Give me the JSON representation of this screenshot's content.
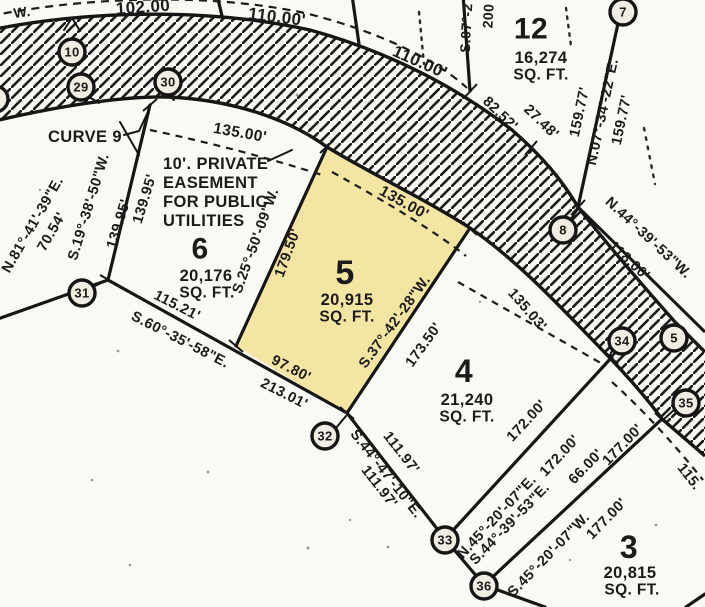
{
  "map": {
    "type": "plat-survey-map",
    "colors": {
      "paper": "#fbf9f3",
      "ink": "#1b1b1b",
      "lot5_highlight": "#f4e5a3"
    },
    "lots": [
      {
        "number": "12",
        "area": "16,274 SQ. FT."
      },
      {
        "number": "6",
        "area": "20,176 SQ. FT."
      },
      {
        "number": "5",
        "area": "20,915 SQ. FT.",
        "highlighted": true
      },
      {
        "number": "4",
        "area": "21,240 SQ. FT."
      },
      {
        "number": "3",
        "area": "20,815 SQ. FT."
      }
    ],
    "labels": [
      {
        "id": "fragment-w",
        "t": "W.",
        "x": 22,
        "y": 12,
        "r": -8,
        "s": 14
      },
      {
        "id": "dim-102-00",
        "t": "102.00",
        "x": 143,
        "y": 7,
        "r": -4,
        "s": 17
      },
      {
        "id": "dim-110-00-a",
        "t": "110.00'",
        "x": 277,
        "y": 17,
        "r": 7,
        "s": 17
      },
      {
        "id": "dim-110-00-b",
        "t": "110.00'",
        "x": 420,
        "y": 62,
        "r": 24,
        "s": 17
      },
      {
        "id": "bearing-s07-partial",
        "t": "S.07°-2",
        "x": 466,
        "y": 28,
        "r": -87,
        "s": 14
      },
      {
        "id": "dim-200-partial",
        "t": "200",
        "x": 488,
        "y": 16,
        "r": -87,
        "s": 14
      },
      {
        "id": "lot12-number",
        "t": "12",
        "x": 531,
        "y": 29,
        "r": 0,
        "s": 30
      },
      {
        "id": "lot12-area",
        "t": "16,274",
        "x": 541,
        "y": 58,
        "r": 0,
        "s": 16.5
      },
      {
        "id": "lot12-sqft",
        "t": "SQ. FT.",
        "x": 541,
        "y": 75,
        "r": 0,
        "s": 15.5
      },
      {
        "id": "dim-82-52",
        "t": "82.52'",
        "x": 500,
        "y": 114,
        "r": 44,
        "s": 14.5
      },
      {
        "id": "dim-27-48",
        "t": "27.48'",
        "x": 541,
        "y": 122,
        "r": 44,
        "s": 14.5
      },
      {
        "id": "dim-159-77-a",
        "t": "159.77'",
        "x": 580,
        "y": 112,
        "r": -78,
        "s": 14.5
      },
      {
        "id": "bearing-n07-34-22e",
        "t": "N.07°-34'-22\"E.",
        "x": 603,
        "y": 112,
        "r": -78,
        "s": 14.5
      },
      {
        "id": "dim-159-77-b",
        "t": "159.77'",
        "x": 622,
        "y": 120,
        "r": -78,
        "s": 14.5
      },
      {
        "id": "bearing-n44-39-53w",
        "t": "N.44°-39'-53\"W.",
        "x": 648,
        "y": 238,
        "r": 43,
        "s": 14.5
      },
      {
        "id": "dim-118-00",
        "t": "118.00'",
        "x": 629,
        "y": 261,
        "r": 43,
        "s": 14.5
      },
      {
        "id": "curve-9",
        "t": "CURVE 9",
        "x": 85,
        "y": 137,
        "r": 0,
        "s": 16.5
      },
      {
        "id": "dim-135-00-lot6",
        "t": "135.00'",
        "x": 240,
        "y": 133,
        "r": 10,
        "s": 15.5
      },
      {
        "id": "easement-line-1",
        "t": "10'. PRIVATE",
        "x": 163,
        "y": 164,
        "r": 0,
        "s": 16.5,
        "a": "s"
      },
      {
        "id": "easement-line-2",
        "t": "EASEMENT",
        "x": 163,
        "y": 183,
        "r": 0,
        "s": 16.5,
        "a": "s"
      },
      {
        "id": "easement-line-3",
        "t": "FOR PUBLIC",
        "x": 163,
        "y": 202,
        "r": 0,
        "s": 16.5,
        "a": "s"
      },
      {
        "id": "easement-line-4",
        "t": "UTILITIES",
        "x": 163,
        "y": 221,
        "r": 0,
        "s": 16.5,
        "a": "s"
      },
      {
        "id": "lot6-number",
        "t": "6",
        "x": 200,
        "y": 249,
        "r": 0,
        "s": 30
      },
      {
        "id": "lot6-area",
        "t": "20,176",
        "x": 206,
        "y": 276,
        "r": 0,
        "s": 16.5
      },
      {
        "id": "lot6-sqft",
        "t": "SQ. FT.",
        "x": 207,
        "y": 293,
        "r": 0,
        "s": 15.5
      },
      {
        "id": "bearing-s19-38-50w",
        "t": "S.19°-38'-50\"W.",
        "x": 89,
        "y": 207,
        "r": -73,
        "s": 14.5
      },
      {
        "id": "dim-139-95-a",
        "t": "139.95'",
        "x": 119,
        "y": 224,
        "r": -73,
        "s": 14.5
      },
      {
        "id": "dim-139-95-b",
        "t": "139.95'",
        "x": 145,
        "y": 199,
        "r": -73,
        "s": 14.5
      },
      {
        "id": "bearing-n81-41-39e",
        "t": "N.81°-41'-39\"E.",
        "x": 33,
        "y": 225,
        "r": -60,
        "s": 14.5
      },
      {
        "id": "dim-70-54",
        "t": "70.54'",
        "x": 52,
        "y": 232,
        "r": -60,
        "s": 14.5
      },
      {
        "id": "dim-115-21",
        "t": "115.21'",
        "x": 177,
        "y": 306,
        "r": 27,
        "s": 14.5
      },
      {
        "id": "bearing-s60-35-58e",
        "t": "S.60°-35'-58\"E.",
        "x": 180,
        "y": 340,
        "r": 27,
        "s": 14.5
      },
      {
        "id": "dim-213-01",
        "t": "213.01'",
        "x": 284,
        "y": 394,
        "r": 27,
        "s": 14.5
      },
      {
        "id": "lot5-number",
        "t": "5",
        "x": 345,
        "y": 273,
        "r": 0,
        "s": 34
      },
      {
        "id": "lot5-area",
        "t": "20,915",
        "x": 347,
        "y": 300,
        "r": 0,
        "s": 16.5
      },
      {
        "id": "lot5-sqft",
        "t": "SQ. FT.",
        "x": 347,
        "y": 317,
        "r": 0,
        "s": 15.5
      },
      {
        "id": "bearing-s25-50-09w",
        "t": "S.25°-50'-09\"W.",
        "x": 256,
        "y": 241,
        "r": -70,
        "s": 14.5
      },
      {
        "id": "dim-179-50",
        "t": "179.50'",
        "x": 288,
        "y": 253,
        "r": -70,
        "s": 14.5
      },
      {
        "id": "dim-135-00-lot5",
        "t": "135.00'",
        "x": 404,
        "y": 203,
        "r": 29,
        "s": 15.5
      },
      {
        "id": "dim-97-80",
        "t": "97.80'",
        "x": 291,
        "y": 369,
        "r": 27,
        "s": 14.5
      },
      {
        "id": "bearing-s37-42-28w",
        "t": "S.37°-42'-28\"W.",
        "x": 395,
        "y": 322,
        "r": -54,
        "s": 14.5
      },
      {
        "id": "dim-173-50",
        "t": "173.50'",
        "x": 424,
        "y": 345,
        "r": -54,
        "s": 14.5
      },
      {
        "id": "lot4-number",
        "t": "4",
        "x": 464,
        "y": 371,
        "r": 0,
        "s": 32
      },
      {
        "id": "lot4-area",
        "t": "21,240",
        "x": 467,
        "y": 400,
        "r": 0,
        "s": 16.5
      },
      {
        "id": "lot4-sqft",
        "t": "SQ. FT.",
        "x": 467,
        "y": 417,
        "r": 0,
        "s": 15.5
      },
      {
        "id": "dim-135-03",
        "t": "135.03'",
        "x": 527,
        "y": 310,
        "r": 49,
        "s": 14.5
      },
      {
        "id": "dim-111-97-a",
        "t": "111.97'",
        "x": 401,
        "y": 453,
        "r": 52,
        "s": 14.5
      },
      {
        "id": "bearing-s44-47-10e",
        "t": "S.44°-47'-10\"E.",
        "x": 386,
        "y": 474,
        "r": 52,
        "s": 14.5
      },
      {
        "id": "dim-111-97-b",
        "t": "111.97'",
        "x": 379,
        "y": 487,
        "r": 52,
        "s": 14.5
      },
      {
        "id": "dim-172-00-a",
        "t": "172.00'",
        "x": 527,
        "y": 421,
        "r": -47,
        "s": 14.5
      },
      {
        "id": "bearing-n45-20-07e",
        "t": "N.45°-20'-07\"E.",
        "x": 497,
        "y": 517,
        "r": -47,
        "s": 14.5
      },
      {
        "id": "dim-172-00-b",
        "t": "172.00'",
        "x": 560,
        "y": 456,
        "r": -47,
        "s": 14.5
      },
      {
        "id": "bearing-s44-39-53e",
        "t": "S.44°-39'-53\"E.",
        "x": 510,
        "y": 524,
        "r": -46,
        "s": 14.5
      },
      {
        "id": "dim-66-00",
        "t": "66.00'",
        "x": 586,
        "y": 467,
        "r": -46,
        "s": 14.5
      },
      {
        "id": "bearing-s45-20-07w",
        "t": "S.45°-20'-07\"W.",
        "x": 549,
        "y": 555,
        "r": -46,
        "s": 14.5
      },
      {
        "id": "dim-177-00-a",
        "t": "177.00'",
        "x": 623,
        "y": 445,
        "r": -46,
        "s": 14.5
      },
      {
        "id": "dim-177-00-b",
        "t": "177.00'",
        "x": 607,
        "y": 519,
        "r": -46,
        "s": 14.5
      },
      {
        "id": "lot3-number",
        "t": "3",
        "x": 629,
        "y": 547,
        "r": 0,
        "s": 32
      },
      {
        "id": "lot3-area",
        "t": "20,815",
        "x": 630,
        "y": 573,
        "r": 0,
        "s": 16.5
      },
      {
        "id": "lot3-sqft",
        "t": "SQ. FT.",
        "x": 632,
        "y": 590,
        "r": 0,
        "s": 15.5
      },
      {
        "id": "dim-115-partial",
        "t": "115.",
        "x": 689,
        "y": 477,
        "r": 52,
        "s": 14.5
      }
    ],
    "markers": [
      {
        "id": "marker-edge-partial",
        "n": "",
        "x": -5,
        "y": 99
      },
      {
        "id": "marker-10",
        "n": "10",
        "x": 72,
        "y": 52
      },
      {
        "id": "marker-29",
        "n": "29",
        "x": 81,
        "y": 87
      },
      {
        "id": "marker-30",
        "n": "30",
        "x": 168,
        "y": 82
      },
      {
        "id": "marker-31",
        "n": "31",
        "x": 82,
        "y": 293
      },
      {
        "id": "marker-32",
        "n": "32",
        "x": 325,
        "y": 436
      },
      {
        "id": "marker-33",
        "n": "33",
        "x": 445,
        "y": 540
      },
      {
        "id": "marker-36",
        "n": "36",
        "x": 484,
        "y": 586
      },
      {
        "id": "marker-8",
        "n": "8",
        "x": 563,
        "y": 230
      },
      {
        "id": "marker-34",
        "n": "34",
        "x": 622,
        "y": 341
      },
      {
        "id": "marker-5",
        "n": "5",
        "x": 674,
        "y": 338
      },
      {
        "id": "marker-35",
        "n": "35",
        "x": 686,
        "y": 403
      },
      {
        "id": "marker-7",
        "n": "7",
        "x": 623,
        "y": 12
      }
    ]
  }
}
